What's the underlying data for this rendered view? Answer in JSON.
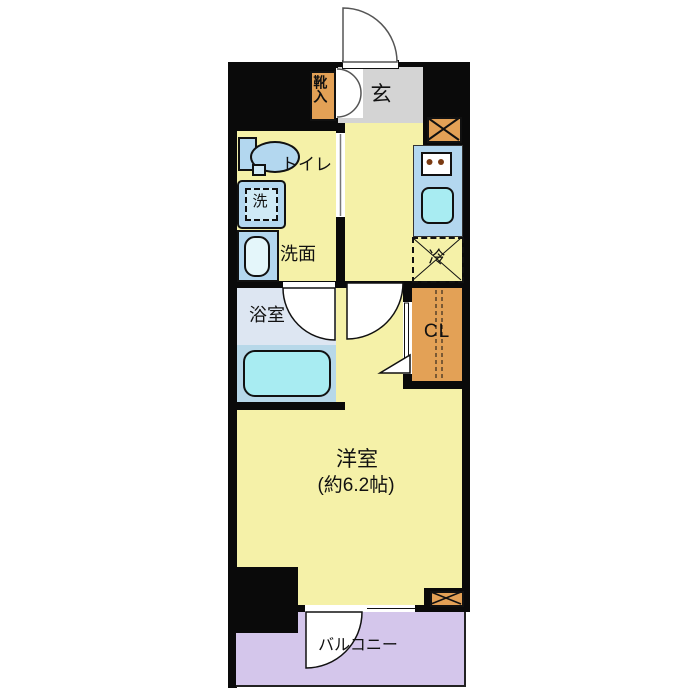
{
  "floorplan": {
    "labels": {
      "entrance": "玄",
      "shoe_cabinet": "靴入",
      "toilet": "トイレ",
      "washing_machine": "洗",
      "washroom": "洗面",
      "bathroom": "浴室",
      "refrigerator": "冷",
      "closet": "CL",
      "main_room": "洋室",
      "main_room_size": "(約6.2帖)",
      "balcony": "バルコニー"
    },
    "colors": {
      "wall": "#0a0a0a",
      "room_yellow": "#f5f1a8",
      "entrance_gray": "#d4d4d4",
      "cabinet_orange": "#e3a156",
      "fixture_blue": "#b3d7ef",
      "water_cyan": "#a8ecf2",
      "bathroom_upper": "#dde6f2",
      "bathtub_zone": "#b7d8e9",
      "balcony_purple": "#d4c6eb"
    }
  }
}
